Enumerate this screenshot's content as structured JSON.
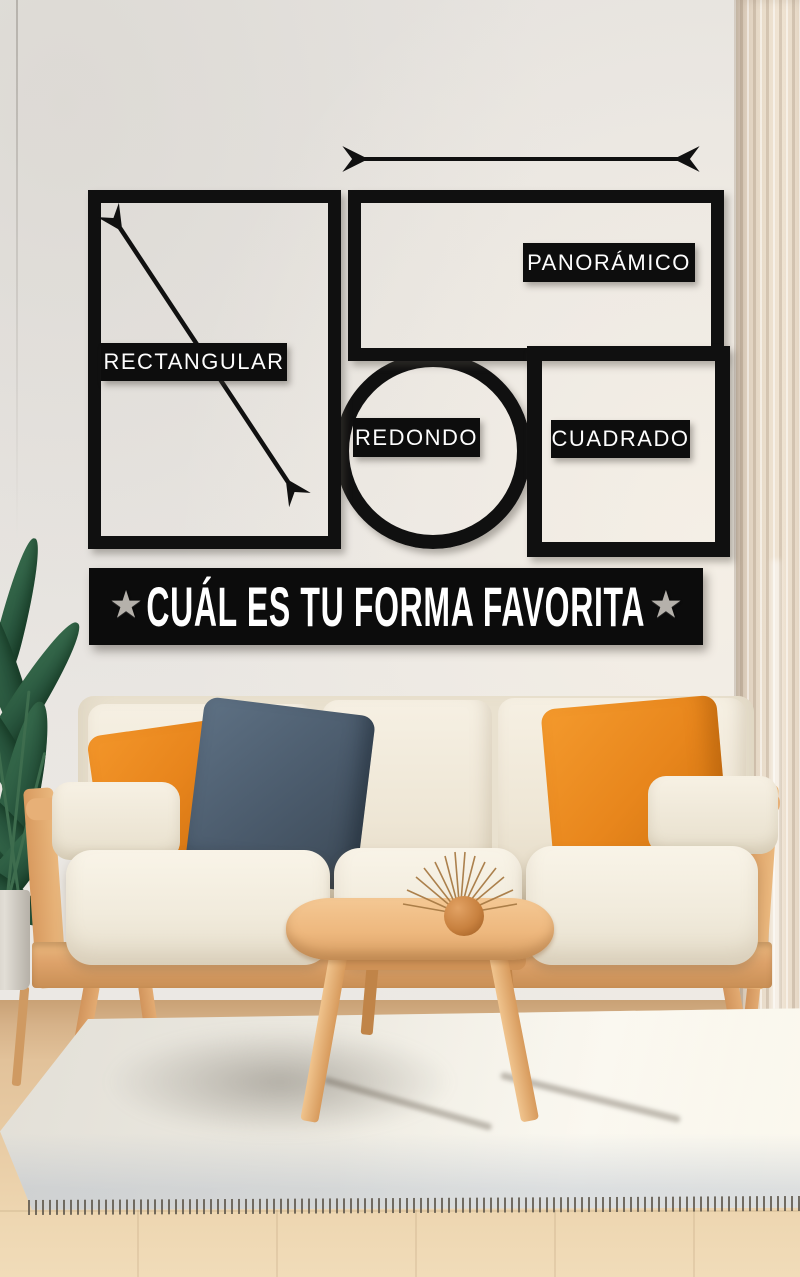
{
  "wall_art": {
    "shapes": [
      {
        "name": "rectangular",
        "label": "RECTANGULAR",
        "geometry": "portrait-rectangle",
        "annotation_icon": "diagonal-double-arrow"
      },
      {
        "name": "panoramico",
        "label": "PANORÁMICO",
        "geometry": "wide-rectangle",
        "annotation_icon": "horizontal-double-arrow"
      },
      {
        "name": "redondo",
        "label": "REDONDO",
        "geometry": "circle"
      },
      {
        "name": "cuadrado",
        "label": "CUADRADO",
        "geometry": "square"
      }
    ],
    "banner": {
      "text": "CUÁL ES TU FORMA FAVORITA",
      "left_star": "★",
      "right_star": "★"
    }
  },
  "palette": {
    "shape_black": "#101010",
    "label_background": "#0d0d0d",
    "label_text": "#ffffff",
    "star_silver": "#b5b1ab",
    "wall": "#e8e5e1",
    "curtain_beige": "#e8dbc9",
    "plant_green": "#2d5c41",
    "sofa_wood": "#dfa571",
    "sofa_cream": "#f2ecdf",
    "pillow_orange": "#e8861c",
    "pillow_slate_blue": "#4a5a6b",
    "table_wood": "#eab87f",
    "rug_cream": "#edeae1",
    "floor_wood": "#e3c59e"
  }
}
